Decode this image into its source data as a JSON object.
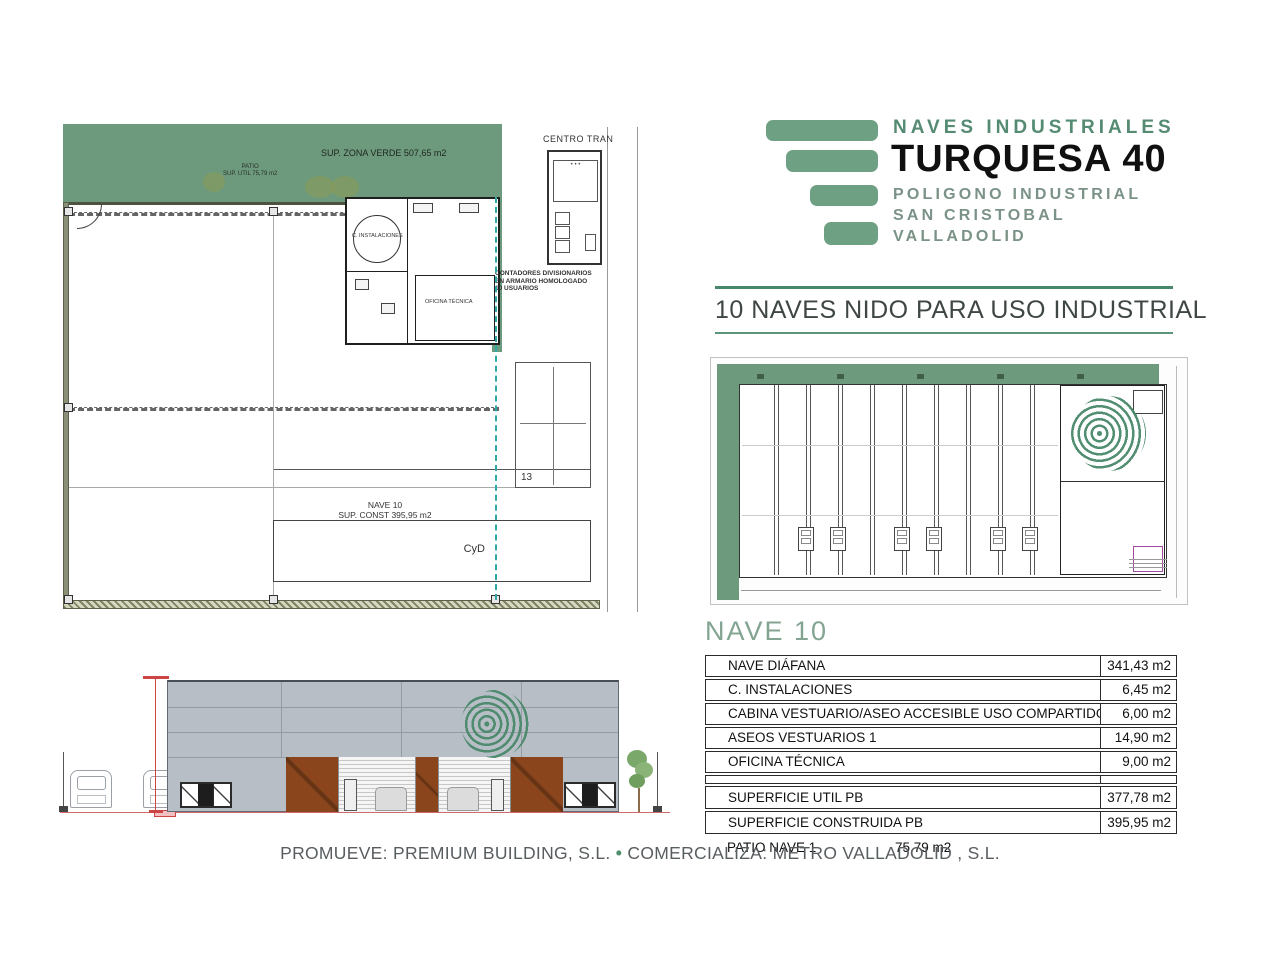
{
  "logo": {
    "title_top": "NAVES INDUSTRIALES",
    "title_main": "TURQUESA 40",
    "subtitle_lines": [
      "POLIGONO INDUSTRIAL",
      "SAN CRISTOBAL",
      "VALLADOLID"
    ]
  },
  "heading": "10 NAVES NIDO PARA USO INDUSTRIAL",
  "floor_plan": {
    "zona_verde_label": "SUP. ZONA VERDE 507,65 m2",
    "patio_label": "PATIO",
    "patio_sup_label": "SUP. UTIL 75,79 m2",
    "centro_label": "CENTRO TRAN",
    "contadores_lines": [
      "CONTADORES DIVISIONARIOS",
      "EN ARMARIO HOMOLOGADO",
      "10 USUARIOS"
    ],
    "instalaciones_label": "C. INSTALACIONES",
    "oficina_label": "OFICINA TÉCNICA",
    "nave_label": "NAVE 10",
    "sup_const_label": "SUP. CONST 395,95 m2",
    "cyd_label": "CyD",
    "parking_label": "13"
  },
  "table": {
    "title": "NAVE 10",
    "rows": [
      {
        "label": "NAVE DIÁFANA",
        "value": "341,43 m2"
      },
      {
        "label": "C. INSTALACIONES",
        "value": "6,45 m2"
      },
      {
        "label": "CABINA VESTUARIO/ASEO ACCESIBLE USO COMPARTIDO",
        "value": "6,00 m2"
      },
      {
        "label": "ASEOS VESTUARIOS 1",
        "value": "14,90 m2"
      },
      {
        "label": "OFICINA TÉCNICA",
        "value": "9,00 m2"
      }
    ],
    "totals": [
      {
        "label": "SUPERFICIE UTIL PB",
        "value": "377,78 m2"
      },
      {
        "label": "SUPERFICIE CONSTRUIDA PB",
        "value": "395,95 m2"
      }
    ],
    "footnote": {
      "label": "PATIO NAVE 1",
      "value": "75,79 m2"
    }
  },
  "footer": {
    "promueve": "PROMUEVE: PREMIUM BUILDING, S.L.",
    "bullet": "•",
    "comercializa": "COMERCIALIZA: METRO VALLADOLID , S.L."
  },
  "colors": {
    "brand_green": "#6ea183",
    "rule_green": "#47886a",
    "zone_green": "#6d9a7c",
    "facade_gray": "#b7bec6",
    "door_brown": "#8a451c",
    "accent_red": "#cc4444"
  }
}
